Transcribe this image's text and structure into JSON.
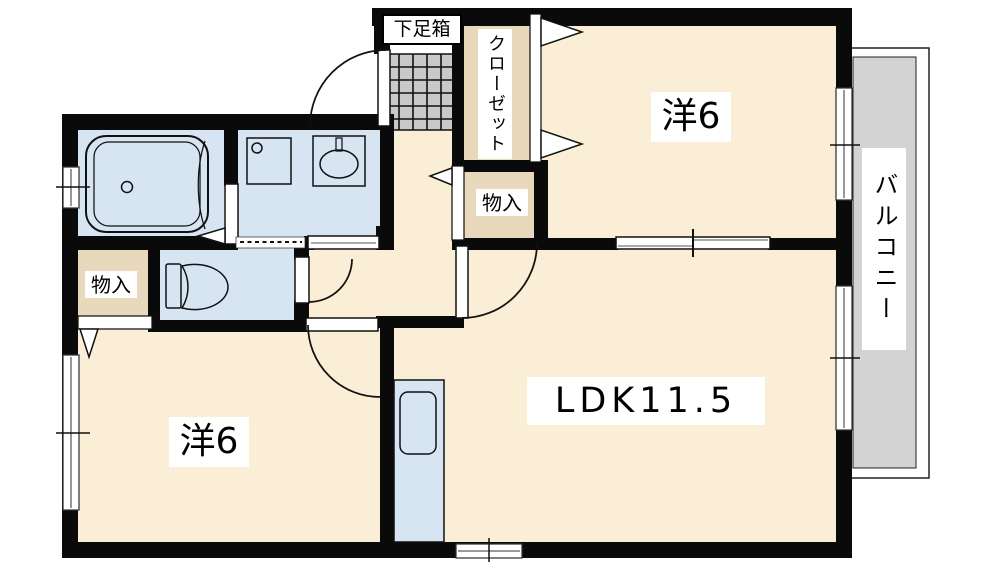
{
  "plan": {
    "type": "apartment-floor-plan",
    "labels": {
      "shoe_box": "下足箱",
      "closet": "クローゼット",
      "storage_upper": "物入",
      "storage_lower": "物入",
      "bedroom_upper": "洋6",
      "bedroom_lower": "洋6",
      "ldk": "LDK11.5",
      "balcony": "バルコニー"
    },
    "rooms": [
      {
        "name": "western-room-upper",
        "label": "洋6"
      },
      {
        "name": "western-room-lower",
        "label": "洋6"
      },
      {
        "name": "living-dining-kitchen",
        "label": "LDK11.5"
      },
      {
        "name": "balcony",
        "label": "バルコニー"
      },
      {
        "name": "closet",
        "label": "クローゼット"
      },
      {
        "name": "storage-upper",
        "label": "物入"
      },
      {
        "name": "storage-lower",
        "label": "物入"
      },
      {
        "name": "entry-shoe-box",
        "label": "下足箱"
      },
      {
        "name": "bathroom",
        "label": ""
      },
      {
        "name": "washroom",
        "label": ""
      },
      {
        "name": "toilet",
        "label": ""
      }
    ],
    "colors": {
      "room_cream": "#FAEED6",
      "storage_tan": "#E8D9BD",
      "wet_area_blue": "#D7E5F2",
      "balcony_gray": "#D3D3D3",
      "entry_tile_gray": "#C9C9C9",
      "wall_black": "#0A0A0A",
      "label_background": "#FFFFFF"
    }
  }
}
